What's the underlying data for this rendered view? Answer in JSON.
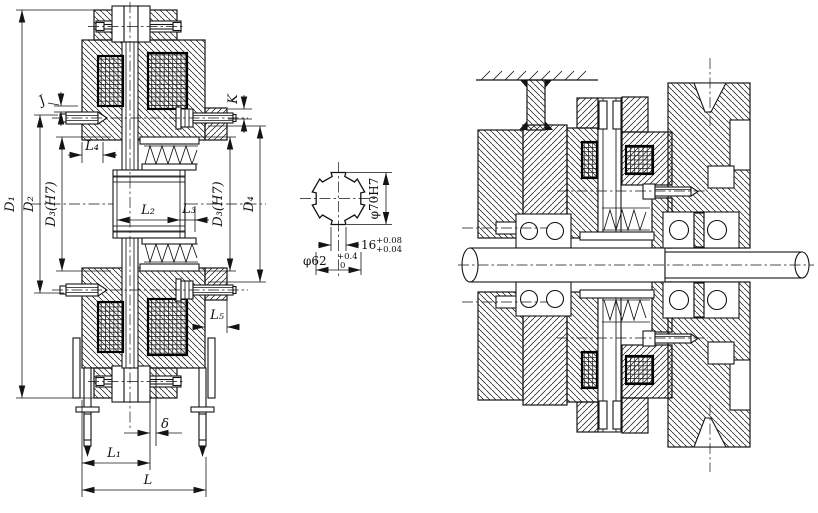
{
  "title": "Electromagnetic multi-plate friction clutch engineering drawing",
  "colors": {
    "line": "#141414",
    "background": "#ffffff"
  },
  "drawing": {
    "left_view": {
      "dim_D1": "D₁",
      "dim_D2": "D₂",
      "dim_D3_left": "D₃(H7)",
      "dim_D3_right": "D₃(H7)",
      "dim_D4": "D₄",
      "dim_J": "J",
      "dim_K": "K",
      "dim_L4": "L₄",
      "dim_L2": "L₂",
      "dim_L3": "L₃",
      "dim_L5": "L₅",
      "dim_delta": "δ",
      "dim_L1": "L₁",
      "dim_L": "L"
    },
    "spline_section": {
      "bore_dia": "φ70H7",
      "key_width": "16",
      "key_width_tol_upper": "+0.08",
      "key_width_tol_lower": "+0.04",
      "minor_dia": "φ62",
      "minor_dia_tol_upper": "+0.4",
      "minor_dia_tol_lower": "0"
    }
  }
}
